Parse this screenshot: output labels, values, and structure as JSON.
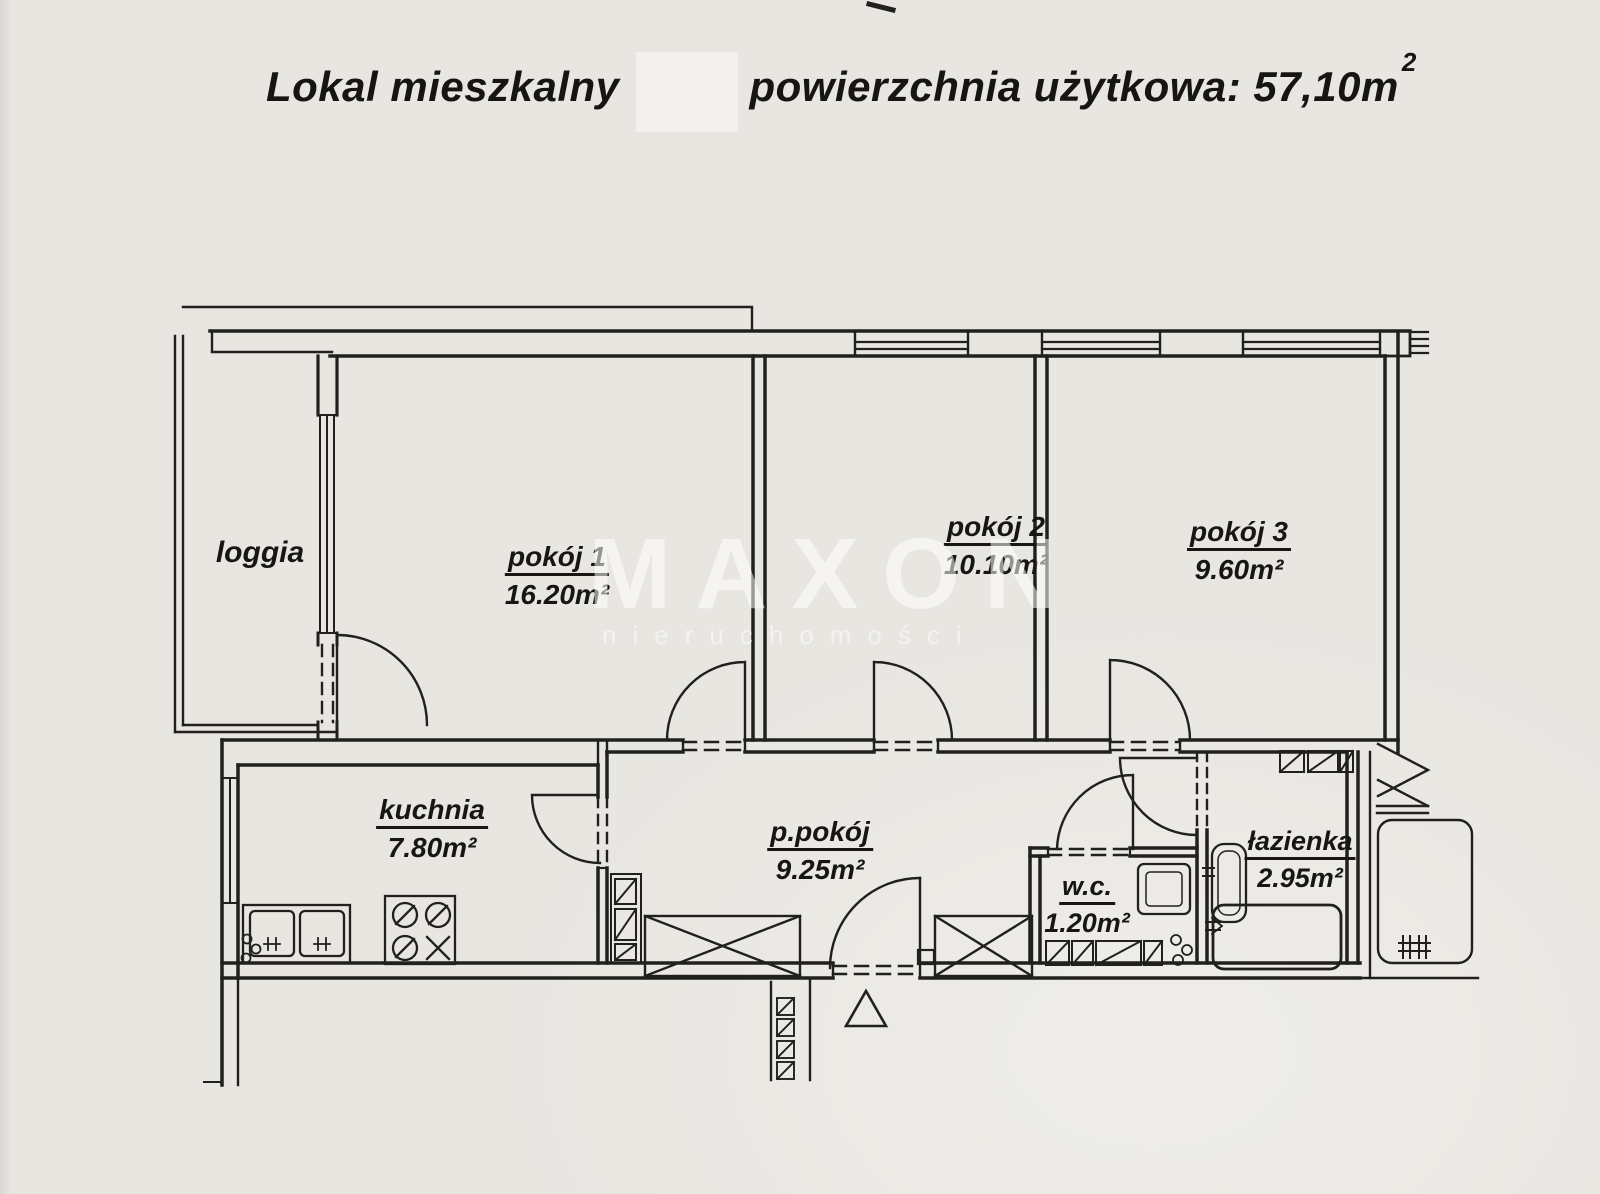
{
  "title": {
    "prefix": "Lokal mieszkalny",
    "suffix": "powierzchnia użytkowa: 57,10m",
    "sup": "2"
  },
  "watermark": {
    "brand": "MAXON",
    "tagline": "nieruchomości"
  },
  "rooms": [
    {
      "label": "loggia",
      "area": ""
    },
    {
      "label": "pokój 1",
      "area": "16.20m²"
    },
    {
      "label": "pokój 2",
      "area": "10.10m²"
    },
    {
      "label": "pokój 3",
      "area": "9.60m²"
    },
    {
      "label": "kuchnia",
      "area": "7.80m²"
    },
    {
      "label": "p.pokój",
      "area": "9.25m²"
    },
    {
      "label": "w.c.",
      "area": "1.20m²"
    },
    {
      "label": "łazienka",
      "area": "2.95m²"
    }
  ]
}
